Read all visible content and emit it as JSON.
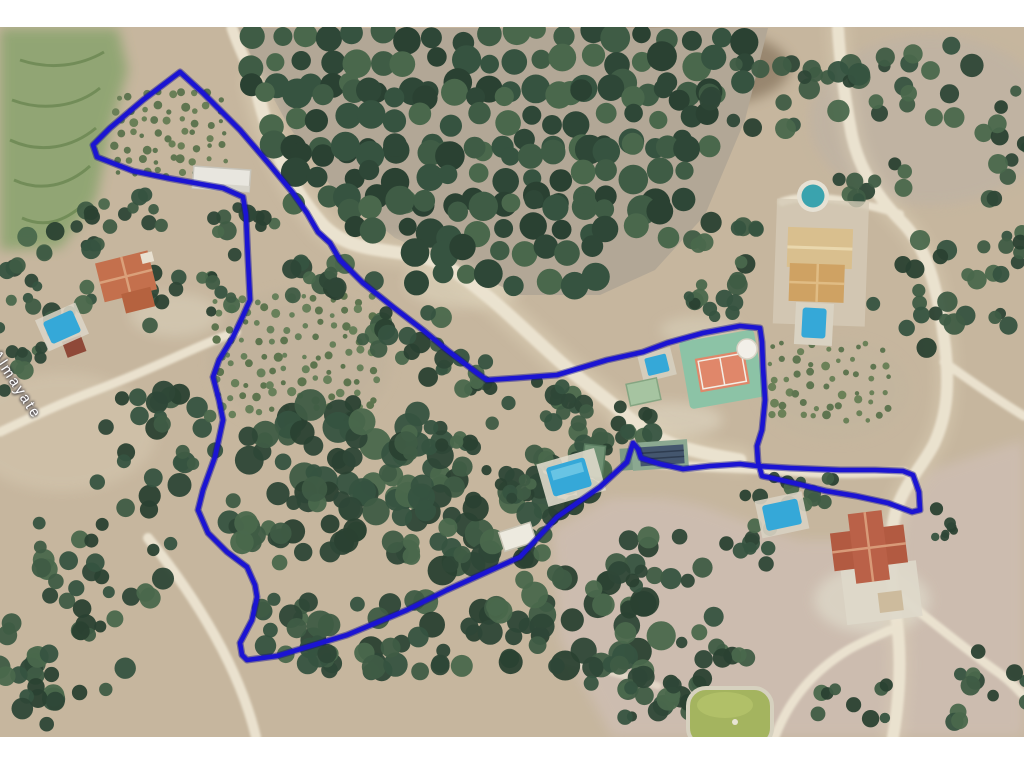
{
  "map": {
    "place_label": "Almayate",
    "colors": {
      "boundary": "#1b14d2",
      "boundary_shadow": "#0e0c8e",
      "pool": "#35a8d8",
      "round_pool": "#3aa3ae",
      "tennis_court": "#e0876a",
      "tennis_pad": "#8cc3a6",
      "pond": "#a4b45f"
    }
  }
}
